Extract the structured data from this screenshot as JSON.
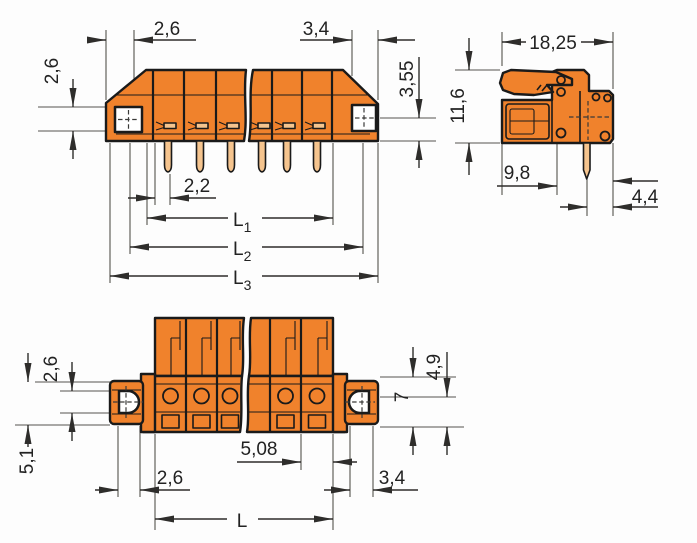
{
  "drawing": {
    "front_view": {
      "dim_end_width_left": "2,6",
      "dim_end_width_right": "3,4",
      "dim_height_left": "2,6",
      "dim_height_right": "3,55",
      "dim_pin": "2,2",
      "dim_l1": {
        "base": "L",
        "sub": "1"
      },
      "dim_l2": {
        "base": "L",
        "sub": "2"
      },
      "dim_l3": {
        "base": "L",
        "sub": "3"
      }
    },
    "side_view": {
      "dim_width": "18,25",
      "dim_height": "11,6",
      "dim_depth": "9,8",
      "dim_pin_to_edge": "4,4"
    },
    "bottom_view": {
      "dim_flange_hole": "2,6",
      "dim_flange_height": "5,1",
      "dim_right_upper": "4,9",
      "dim_right_lower": "7",
      "dim_pitch": "5,08",
      "dim_left_edge": "2,6",
      "dim_right_edge": "3,4",
      "dim_length": "L"
    },
    "colors": {
      "body_orange": "#F0822C",
      "pin_copper": "#F5C48E",
      "outline": "#1A1A1A",
      "dimension_line": "#55534E",
      "label_text": "#222222",
      "hole_white": "#FFFFFF",
      "background": "#FDFDFD"
    }
  }
}
